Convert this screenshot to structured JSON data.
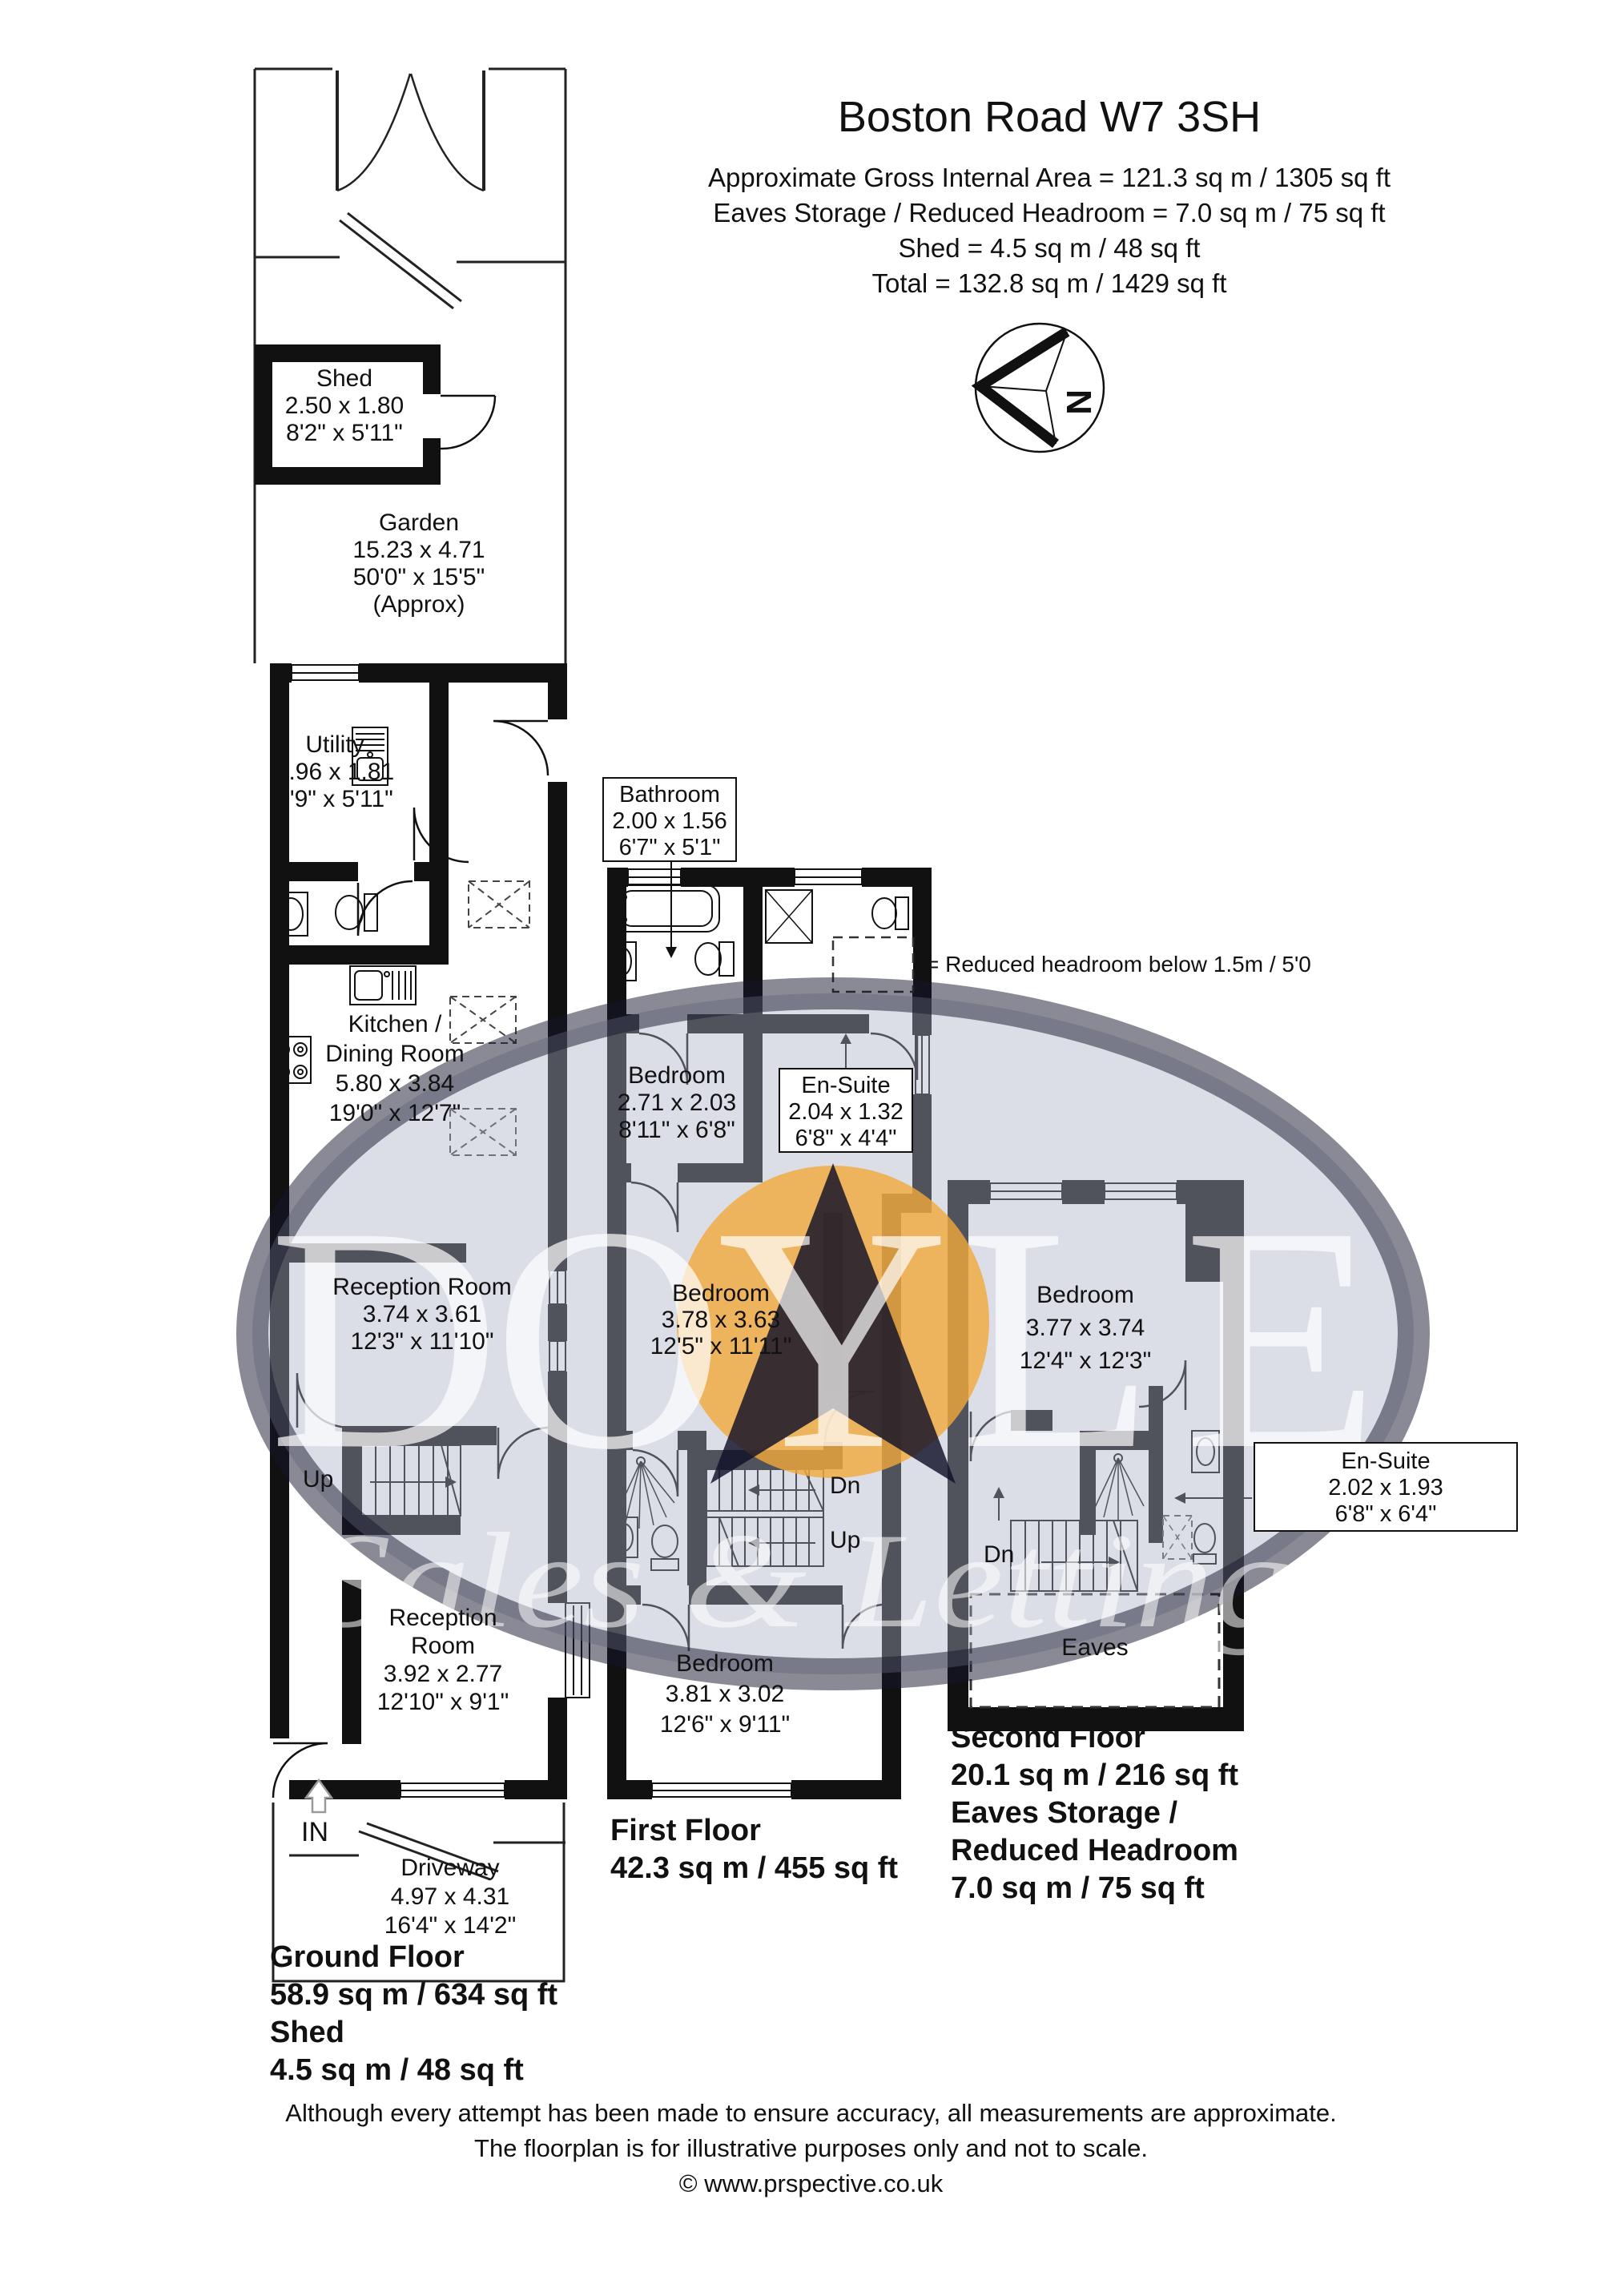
{
  "header": {
    "title": "Boston Road W7 3SH",
    "lines": [
      "Approximate Gross Internal Area =  121.3 sq m / 1305 sq ft",
      "Eaves Storage / Reduced Headroom = 7.0 sq m / 75 sq ft",
      "Shed = 4.5 sq m / 48 sq ft",
      "Total = 132.8 sq m / 1429 sq ft"
    ]
  },
  "compass": {
    "north_label": "N"
  },
  "legend": {
    "text": "= Reduced headroom below 1.5m / 5'0"
  },
  "watermark": {
    "letters": [
      "D",
      "O",
      "Y",
      "L",
      "E"
    ],
    "tagline": "Sales & Lettings",
    "accent_color": "#f2a93b",
    "ellipse_color": "#aab0c4"
  },
  "ground_floor": {
    "labels": {
      "shed": [
        "Shed",
        "2.50 x 1.80",
        "8'2\" x 5'11\""
      ],
      "garden": [
        "Garden",
        "15.23 x 4.71",
        "50'0\" x 15'5\"",
        "(Approx)"
      ],
      "utility": [
        "Utility",
        "2.96 x 1.81",
        "9'9\" x 5'11\""
      ],
      "kitchen": [
        "Kitchen /",
        "Dining Room",
        "5.80 x 3.84",
        "19'0\" x 12'7\""
      ],
      "reception1": [
        "Reception Room",
        "3.74 x 3.61",
        "12'3\" x 11'10\""
      ],
      "reception2": [
        "Reception",
        "Room",
        "3.92 x 2.77",
        "12'10\" x 9'1\""
      ],
      "driveway": [
        "Driveway",
        "4.97 x 4.31",
        "16'4\" x 14'2\""
      ]
    },
    "stairs_up": "Up",
    "entrance": "IN",
    "footer": [
      "Ground Floor",
      "58.9 sq m / 634 sq ft",
      "Shed",
      "4.5 sq m / 48 sq ft"
    ]
  },
  "first_floor": {
    "labels": {
      "bathroom": [
        "Bathroom",
        "2.00 x 1.56",
        "6'7\" x 5'1\""
      ],
      "bedroom_rear": [
        "Bedroom",
        "2.71 x 2.03",
        "8'11\" x 6'8\""
      ],
      "ensuite": [
        "En-Suite",
        "2.04 x 1.32",
        "6'8\" x 4'4\""
      ],
      "bedroom_middle": [
        "Bedroom",
        "3.78 x 3.63",
        "12'5\" x 11'11\""
      ],
      "bedroom_front": [
        "Bedroom",
        "3.81 x 3.02",
        "12'6\" x 9'11\""
      ]
    },
    "stairs_dn": "Dn",
    "stairs_up": "Up",
    "footer": [
      "First Floor",
      "42.3 sq m / 455 sq ft"
    ]
  },
  "second_floor": {
    "labels": {
      "bedroom": [
        "Bedroom",
        "3.77 x 3.74",
        "12'4\" x 12'3\""
      ],
      "ensuite": [
        "En-Suite",
        "2.02 x 1.93",
        "6'8\" x 6'4\""
      ],
      "eaves": "Eaves"
    },
    "stairs_dn": "Dn",
    "footer": [
      "Second Floor",
      "20.1 sq m / 216 sq ft",
      "Eaves Storage /",
      "Reduced Headroom",
      "7.0 sq m / 75 sq ft"
    ]
  },
  "disclaimer": [
    "Although every attempt has been made to ensure accuracy, all measurements are approximate.",
    "The floorplan is for illustrative purposes only and not to scale.",
    "© www.prspective.co.uk"
  ]
}
